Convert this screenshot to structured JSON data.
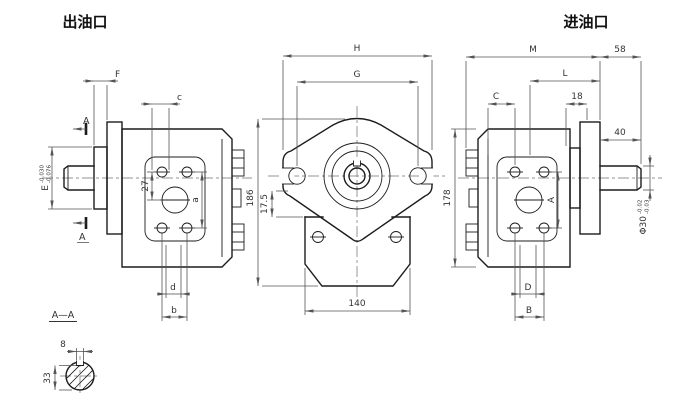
{
  "drawing": {
    "title_left": "出油口",
    "title_right": "进油口",
    "section_title": "A—A",
    "section_marker": "A"
  },
  "dims": {
    "left": {
      "F": "F",
      "c": "c",
      "E": "E",
      "E_tol_upper": "-0.030",
      "E_tol_lower": "-0.076",
      "offset_27": "27",
      "a": "a",
      "d": "d",
      "b": "b"
    },
    "front": {
      "H": "H",
      "G": "G",
      "height_186": "186",
      "offset_17_5": "17.5",
      "width_140": "140"
    },
    "right": {
      "M": "M",
      "width_58": "58",
      "L": "L",
      "C": "C",
      "width_18": "18",
      "width_40": "40",
      "A": "A",
      "shaft_dia": "Φ30",
      "shaft_tol_upper": "-0.02",
      "shaft_tol_lower": "-0.03",
      "height_178": "178",
      "D": "D",
      "B": "B"
    },
    "section": {
      "key_width_8": "8",
      "depth_33": "33"
    }
  }
}
